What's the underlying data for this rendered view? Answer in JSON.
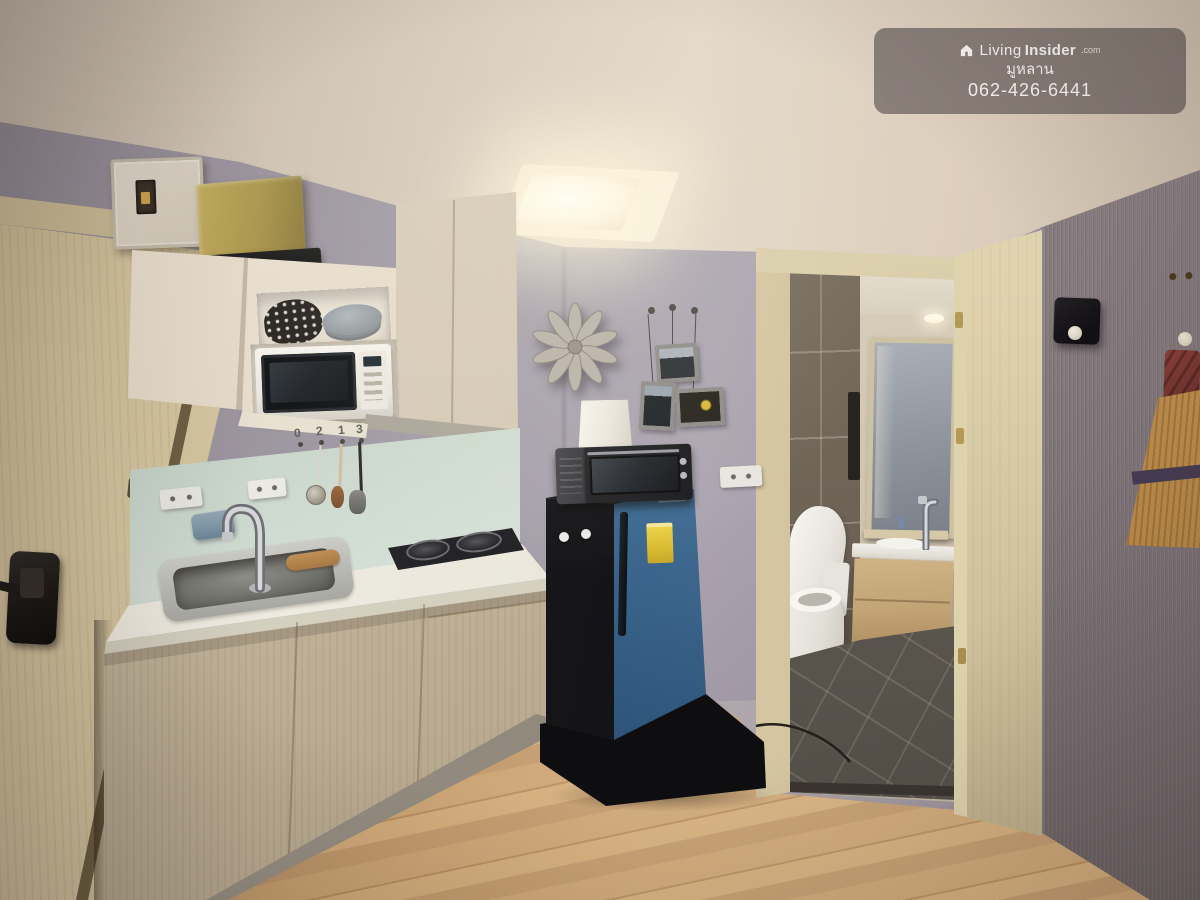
{
  "watermark": {
    "brand": {
      "light": "Living",
      "bold": "Insider",
      "suffix": ".com"
    },
    "line2": "มูหลาน",
    "line3": "062-426-6441"
  },
  "backsplash": {
    "hook_numbers": [
      "0",
      "2",
      "1",
      "3"
    ]
  },
  "scene": {
    "type": "interior-photograph",
    "description": "Compact condo kitchen with light wood cabinets, mint glass backsplash, white microwave, blue single-door refrigerator with mini oven and lamp shade on top, starburst wall clock, three hanging picture frames, open doorway to bathroom with toilet, wooden vanity and mirror, textured gray wall with straw broom ornament, light wood laminate floor",
    "colors": {
      "ceiling": "#ddd2c2",
      "wall_lavender": "#a49dab",
      "right_wall": "#7c7276",
      "door_cream": "#d8caa6",
      "cabinet_wood": "#cbbda4",
      "backsplash_mint": "#cdd9cd",
      "countertop": "#ece9dd",
      "floor_wood": "#c79f6c",
      "fridge_blue": "#2d5d8b",
      "fridge_black": "#141416",
      "energy_label_yellow": "#e2c63c",
      "bathroom_tile": "#6f6557",
      "bathroom_floor": "#5e5a52"
    }
  }
}
